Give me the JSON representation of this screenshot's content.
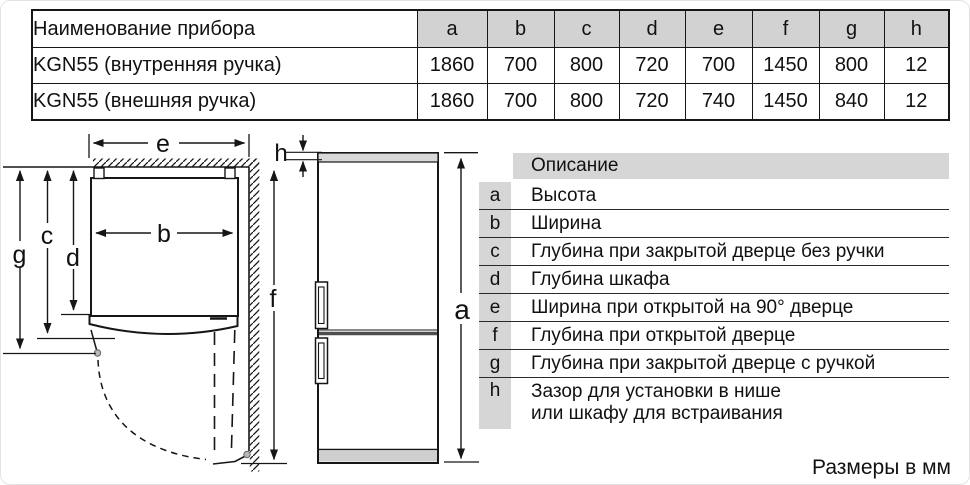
{
  "spec_table": {
    "name_header": "Наименование прибора",
    "dim_headers": [
      "a",
      "b",
      "c",
      "d",
      "e",
      "f",
      "g",
      "h"
    ],
    "rows": [
      {
        "name": "KGN55 (внутренняя ручка)",
        "values": [
          "1860",
          "700",
          "800",
          "720",
          "700",
          "1450",
          "800",
          "12"
        ]
      },
      {
        "name": "KGN55 (внешняя ручка)",
        "values": [
          "1860",
          "700",
          "800",
          "720",
          "740",
          "1450",
          "840",
          "12"
        ]
      }
    ]
  },
  "legend": {
    "header": "Описание",
    "rows": [
      {
        "key": "a",
        "desc": "Высота"
      },
      {
        "key": "b",
        "desc": "Ширина"
      },
      {
        "key": "c",
        "desc": "Глубина при закрытой дверце без ручки"
      },
      {
        "key": "d",
        "desc": "Глубина шкафа"
      },
      {
        "key": "e",
        "desc": "Ширина при открытой на 90° дверце"
      },
      {
        "key": "f",
        "desc": "Глубина при открытой дверце"
      },
      {
        "key": "g",
        "desc": "Глубина при закрытой дверце с ручкой"
      },
      {
        "key": "h",
        "desc": "Зазор для установки в нише",
        "desc2": "или шкафу для встраивания"
      }
    ]
  },
  "diagram": {
    "labels": {
      "a": "a",
      "b": "b",
      "c": "c",
      "d": "d",
      "e": "e",
      "f": "f",
      "g": "g",
      "h": "h"
    }
  },
  "footer": {
    "units_note": "Размеры в мм"
  },
  "colors": {
    "line": "#161616",
    "header_fill": "#d2d2d2",
    "legend_fill": "#d6d6d6",
    "fridge_top_fill": "#d8d8d8",
    "plinth_fill": "#cfcfcf",
    "hinge_fill": "#b9b9b9",
    "divider_fill": "#4d4d4d"
  }
}
